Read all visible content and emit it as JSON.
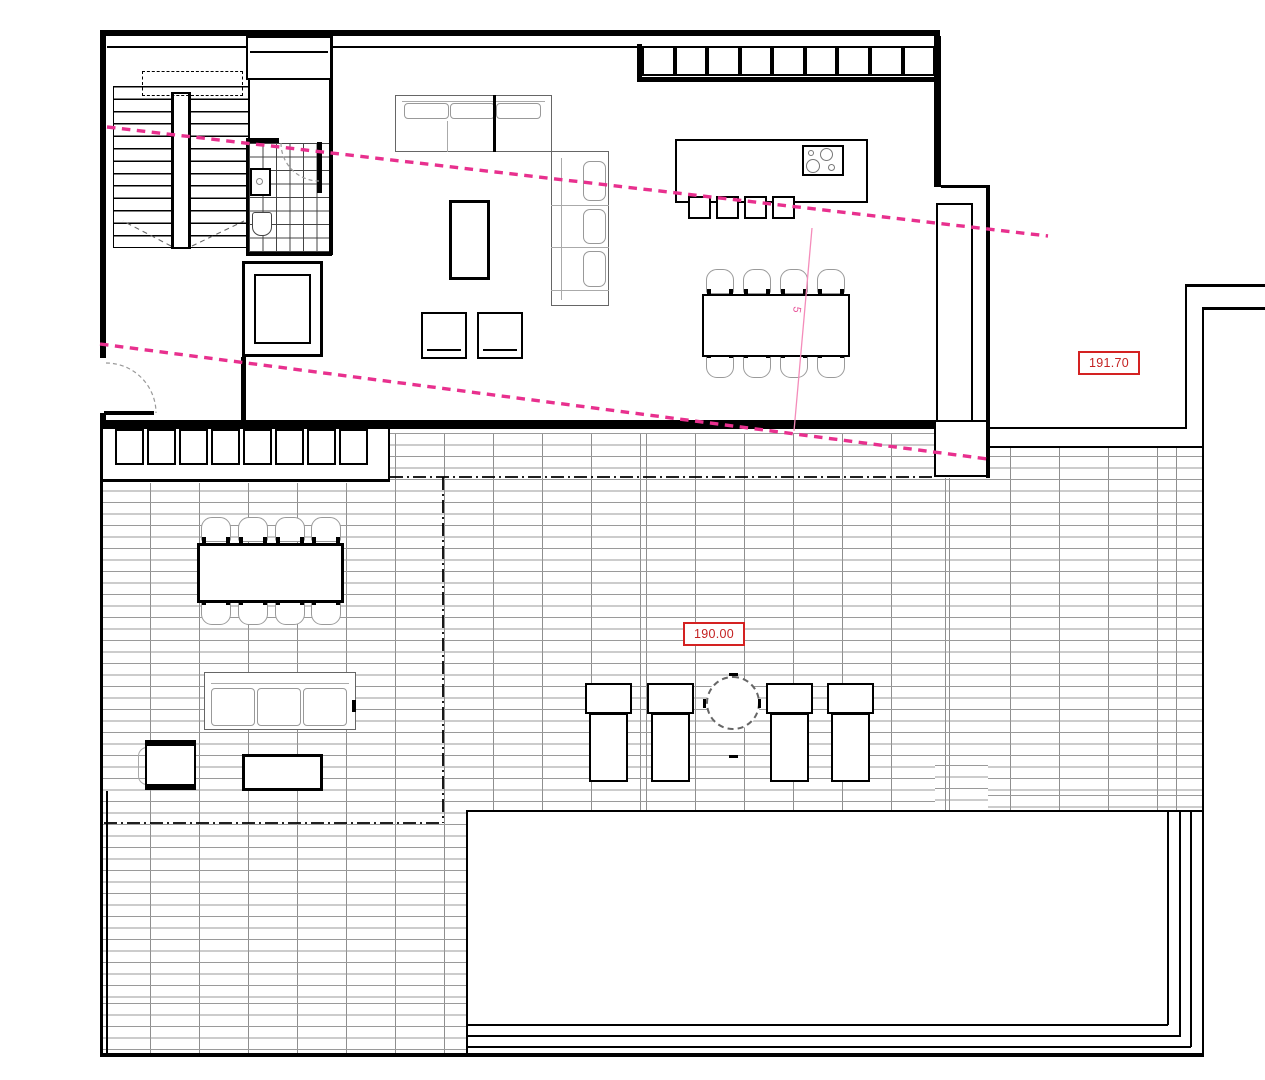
{
  "drawing": {
    "type": "architectural floor plan",
    "labels": {
      "elevation_upper": "191.70",
      "elevation_terrace": "190.00",
      "section_marker": "5"
    },
    "colors": {
      "section_line": "#e8308e",
      "elevation_red": "#c42121",
      "tile_joint": "#9a9a9a",
      "walls": "#000000"
    }
  }
}
